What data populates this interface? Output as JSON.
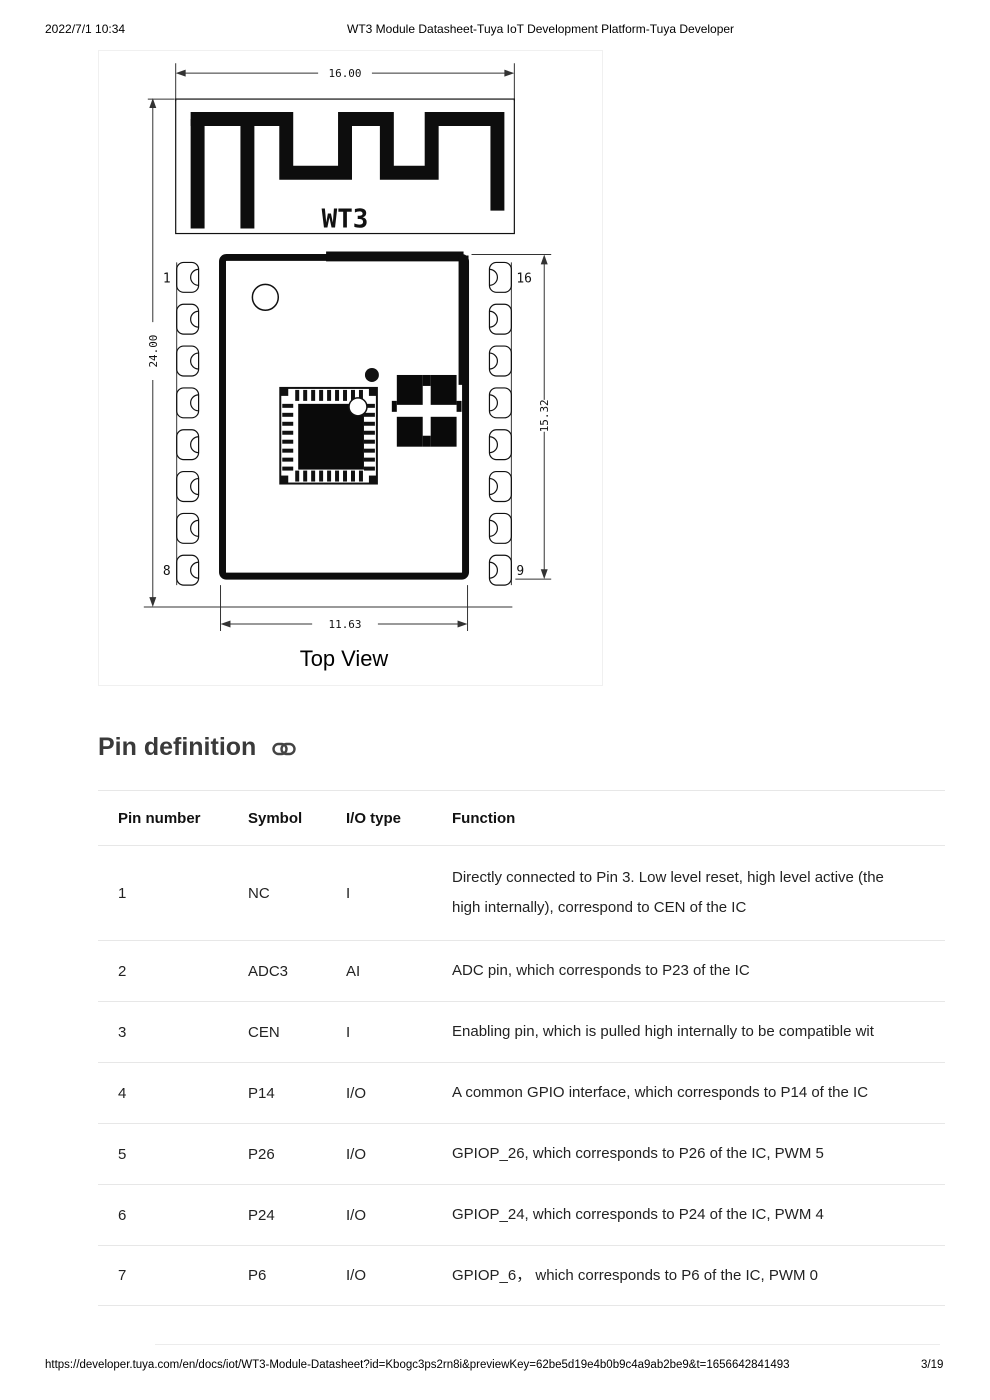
{
  "header": {
    "date": "2022/7/1 10:34",
    "title": "WT3 Module Datasheet-Tuya IoT Development Platform-Tuya Developer"
  },
  "diagram": {
    "module_label": "WT3",
    "caption": "Top View",
    "dimensions": {
      "overall_width": "16.00",
      "overall_height": "24.00",
      "body_height": "15.32",
      "body_width": "11.63"
    },
    "pin_markers": {
      "top_left": "1",
      "bottom_left": "8",
      "top_right": "16",
      "bottom_right": "9"
    }
  },
  "section": {
    "title": "Pin definition"
  },
  "pin_table": {
    "columns": [
      "Pin number",
      "Symbol",
      "I/O type",
      "Function"
    ],
    "rows": [
      {
        "pin": "1",
        "symbol": "NC",
        "io": "I",
        "function_lines": [
          "Directly connected to Pin 3. Low level reset, high level active (the",
          "high internally), correspond to CEN of the IC"
        ]
      },
      {
        "pin": "2",
        "symbol": "ADC3",
        "io": "AI",
        "function_lines": [
          "ADC pin, which corresponds to P23 of the IC"
        ]
      },
      {
        "pin": "3",
        "symbol": "CEN",
        "io": "I",
        "function_lines": [
          "Enabling pin, which is pulled high internally to be compatible wit"
        ]
      },
      {
        "pin": "4",
        "symbol": "P14",
        "io": "I/O",
        "function_lines": [
          "A common GPIO interface, which corresponds to P14 of the IC"
        ]
      },
      {
        "pin": "5",
        "symbol": "P26",
        "io": "I/O",
        "function_lines": [
          "GPIOP_26, which corresponds to P26 of the IC, PWM 5"
        ]
      },
      {
        "pin": "6",
        "symbol": "P24",
        "io": "I/O",
        "function_lines": [
          "GPIOP_24, which corresponds to P24 of the IC, PWM 4"
        ]
      },
      {
        "pin": "7",
        "symbol": "P6",
        "io": "I/O",
        "function_lines": [
          "GPIOP_6， which corresponds to P6 of the IC, PWM 0"
        ]
      }
    ]
  },
  "footer": {
    "url": "https://developer.tuya.com/en/docs/iot/WT3-Module-Datasheet?id=Kbogc3ps2rn8i&previewKey=62be5d19e4b0b9c4a9ab2be9&t=1656642841493",
    "page": "3/19"
  }
}
